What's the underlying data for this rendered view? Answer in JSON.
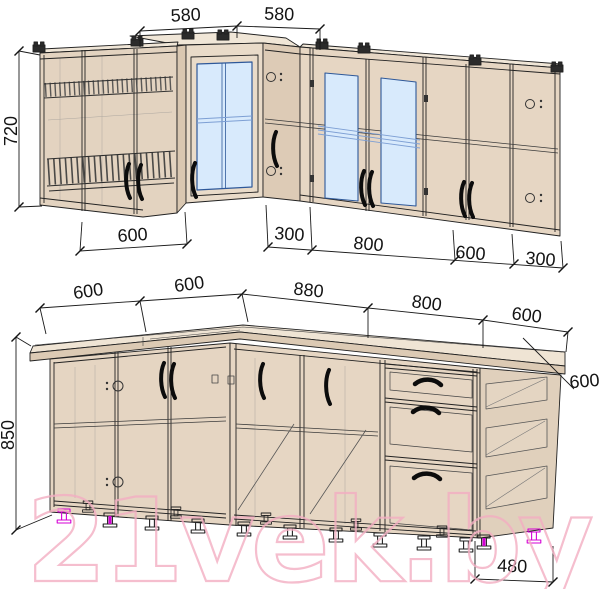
{
  "watermark": {
    "text": "21vek.by"
  },
  "upper_cabinets": {
    "dim_width_corner_left": "580",
    "dim_width_corner_right": "580",
    "dim_height": "720",
    "dim_width_1": "600",
    "dim_width_2": "300",
    "dim_width_3": "800",
    "dim_width_4": "600",
    "dim_width_5": "300"
  },
  "base_cabinets": {
    "dim_width_1": "600",
    "dim_width_2": "600",
    "dim_width_3": "880",
    "dim_width_4": "800",
    "dim_width_5": "600",
    "dim_height": "850",
    "dim_depth": "600",
    "dim_bottom_width": "480"
  }
}
